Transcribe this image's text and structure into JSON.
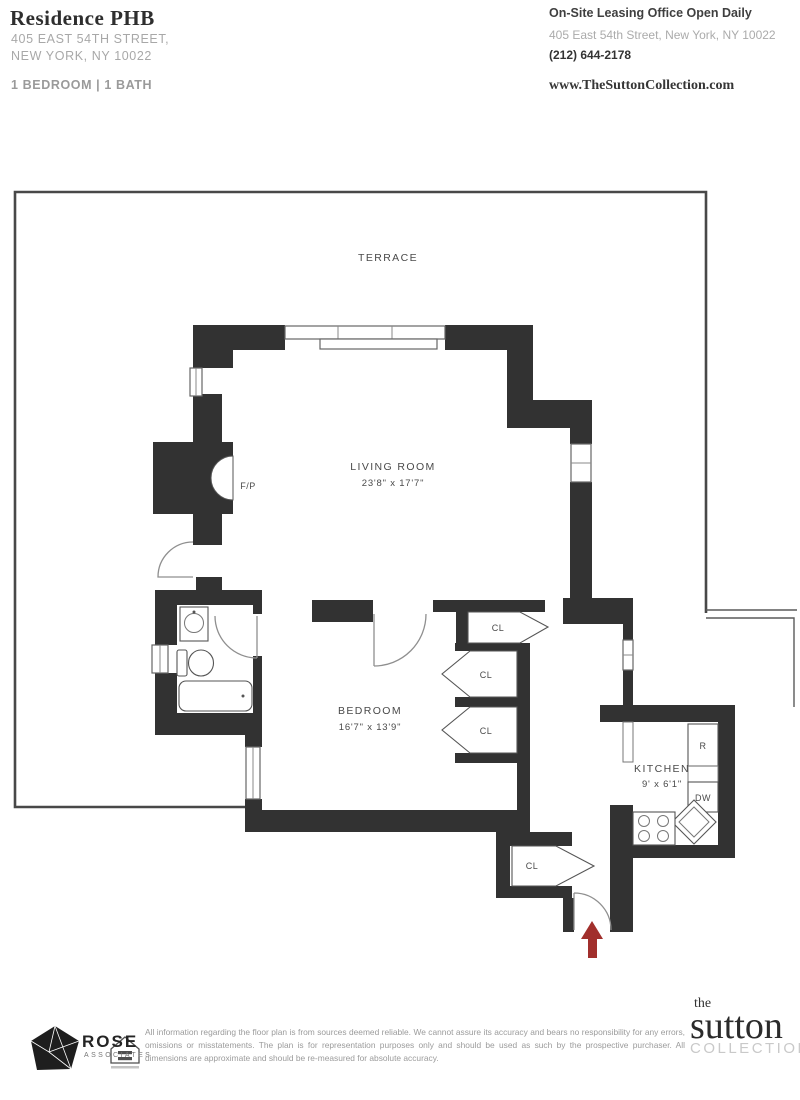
{
  "header": {
    "title": "Residence PHB",
    "address_line1": "405 EAST 54TH STREET,",
    "address_line2": "NEW YORK, NY 10022",
    "unit_config": "1 BEDROOM | 1 BATH",
    "leasing_title": "On-Site Leasing Office Open Daily",
    "leasing_address": "405 East 54th Street, New York, NY 10022",
    "leasing_phone": "(212) 644-2178",
    "website": "www.TheSuttonCollection.com"
  },
  "plan": {
    "terrace_label": "TERRACE",
    "living_room_name": "LIVING ROOM",
    "living_room_dims": "23'8\" x 17'7\"",
    "bedroom_name": "BEDROOM",
    "bedroom_dims": "16'7\" x 13'9\"",
    "kitchen_name": "KITCHEN",
    "kitchen_dims": "9' x 6'1\"",
    "fireplace_label": "F/P",
    "closet1_label": "CL",
    "closet2_label": "CL",
    "closet3_label": "CL",
    "closet4_label": "CL",
    "refrigerator_label": "R",
    "dishwasher_label": "DW"
  },
  "footer": {
    "brand_name": "ROSE",
    "brand_sub": "ASSOCIATES",
    "disclaimer": "All information regarding the floor plan is from sources deemed reliable. We cannot assure its accuracy and bears no responsibility for any errors, omissions or misstatements. The plan is for representation purposes only and should be used as such by the prospective purchaser. All dimensions are approximate and should be re-measured for absolute accuracy.",
    "collection_the": "the",
    "collection_name": "sutton",
    "collection_sub": "COLLECTION"
  },
  "colors": {
    "wall": "#323232",
    "accent_red": "#a12f2c"
  }
}
